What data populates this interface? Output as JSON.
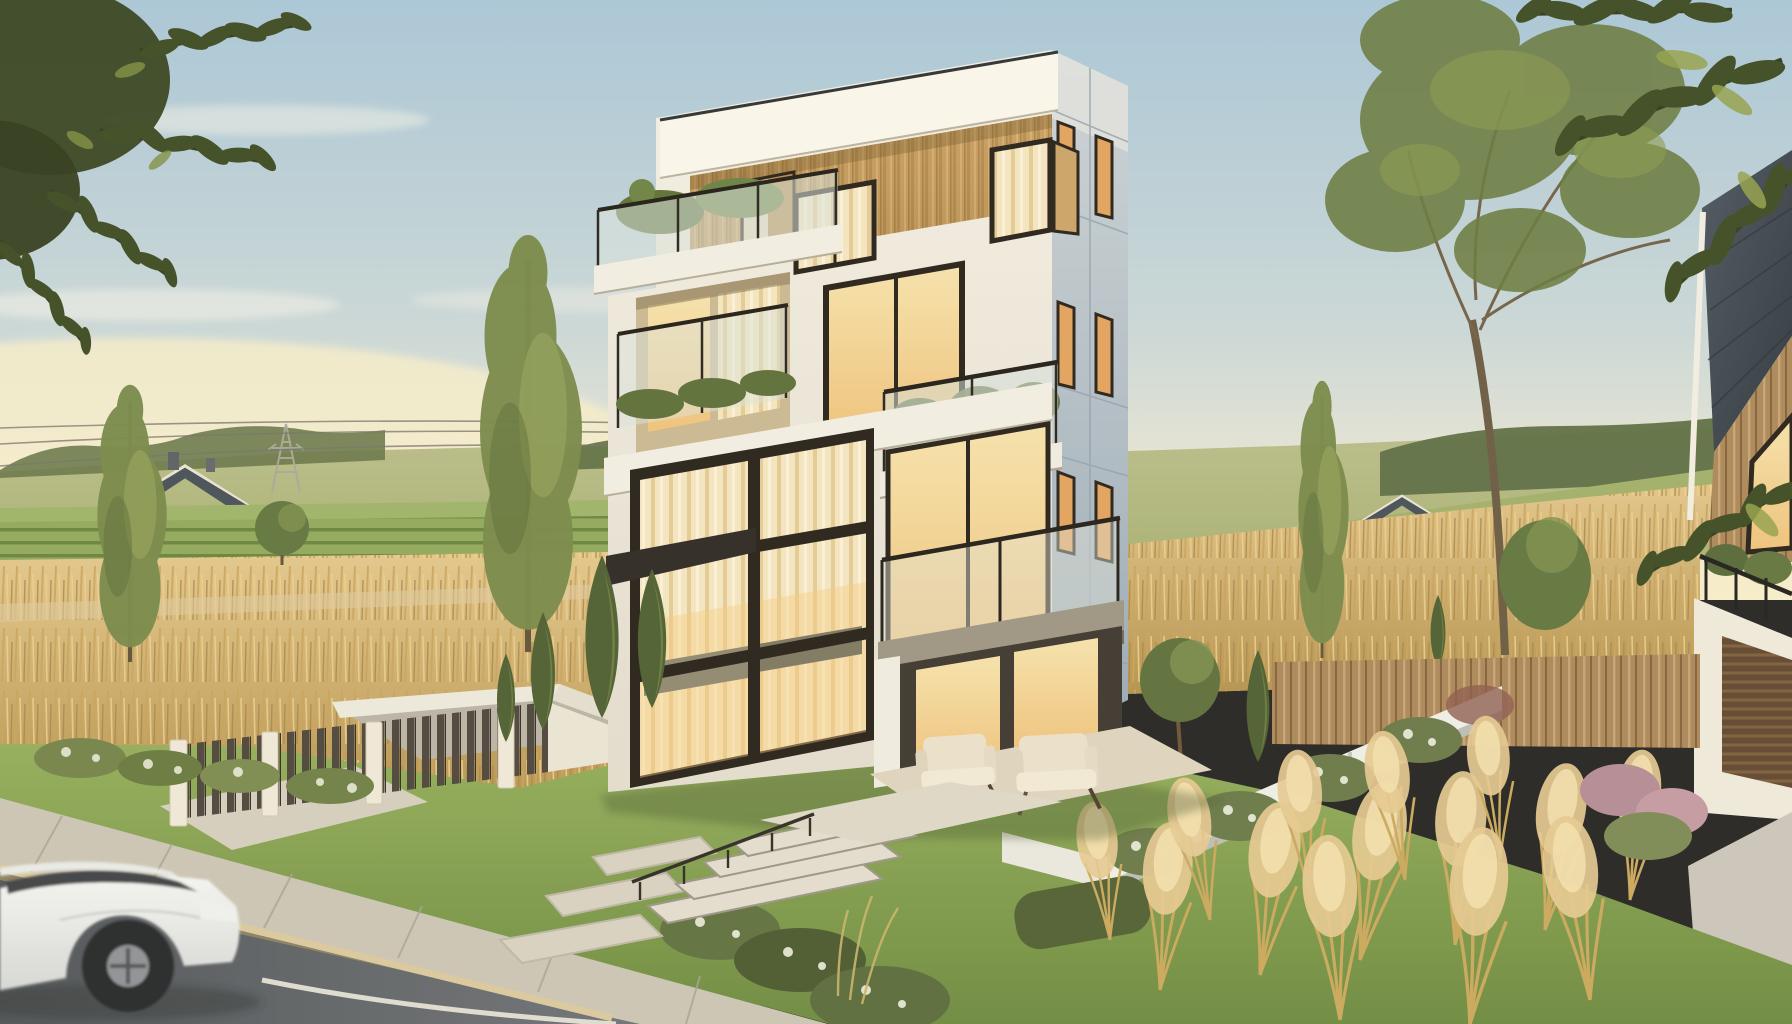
{
  "scene": {
    "title": "Modern three-storey house with timber-clad top floor in a golden-hour suburban field landscape",
    "type": "photorealistic architectural exterior render",
    "time_of_day": "late afternoon golden hour",
    "sky": "clear pale blue sky with warm haze and thin clouds near the horizon",
    "setting": "new suburban street bordered by an asphalt road, sidewalk, wheat fields and rolling hills"
  },
  "objects": [
    {
      "name": "main-house",
      "description": "cubic modern house, white panel facade, vertical timber cladding on top floor, black window frames, glass balconies, warm lit interiors"
    },
    {
      "name": "roof-terrace",
      "description": "glass-railed roof terrace with planter greenery on the third-floor roof"
    },
    {
      "name": "double-height-glazing",
      "description": "two-storey window wall with black mullion grid and cream curtains"
    },
    {
      "name": "porch",
      "description": "recessed ground-floor terrace with two cream armchairs"
    },
    {
      "name": "entrance-steps",
      "description": "light concrete steps with a thin black handrail and stepping-stone path"
    },
    {
      "name": "front-fence",
      "description": "white masonry pillars with dark vertical metal slats"
    },
    {
      "name": "driveway-ramp",
      "description": "white-walled driveway ramp beside the fence"
    },
    {
      "name": "white-suv",
      "description": "white SUV driving past on the road, slightly motion-blurred"
    },
    {
      "name": "road",
      "description": "dark asphalt road with painted white edge line and tan curb"
    },
    {
      "name": "sidewalk",
      "description": "light concrete sidewalk with diagonal joint lines"
    },
    {
      "name": "front-lawn",
      "description": "green lawn with flower beds and clipped shrubs"
    },
    {
      "name": "cypresses",
      "description": "slender dark conifers in the left garden"
    },
    {
      "name": "poplar-trees",
      "description": "three columnar poplar trees"
    },
    {
      "name": "large-tree",
      "description": "tall open-crowned deciduous tree right of the house"
    },
    {
      "name": "overhanging-leaves",
      "description": "dark leafy branches framing the upper corners"
    },
    {
      "name": "wheat-field",
      "description": "golden grain field with green crop rows behind the fence"
    },
    {
      "name": "rolling-hills",
      "description": "olive-green distant hills with a dark tree line"
    },
    {
      "name": "distant-houses-left",
      "description": "cluster of small white gabled houses with slate roofs and chimneys"
    },
    {
      "name": "distant-house-right",
      "description": "single white gabled house across the right field"
    },
    {
      "name": "power-pylon",
      "description": "lattice transmission tower with sagging power lines"
    },
    {
      "name": "retaining-wall",
      "description": "low white garden wall running diagonally up the slope"
    },
    {
      "name": "pampas-grass",
      "description": "feathery golden ornamental grasses in the right garden"
    },
    {
      "name": "boxwood-hedge",
      "description": "clipped dark green hedge"
    },
    {
      "name": "wooden-fence",
      "description": "run of vertical timber fence boards behind the garden"
    },
    {
      "name": "neighbor-house",
      "description": "adjacent house with dark shingled roof, timber gable, balcony and slatted garage door"
    }
  ],
  "palette": {
    "sky-top": "#a7c6da",
    "sky-mid": "#c9d8da",
    "sky-horizon": "#efead7",
    "horizon-glow": "#f7eecb",
    "hill": "#a8b277",
    "treeline": "#66774a",
    "wheat": "#d8b876",
    "wheat-dark": "#b3924f",
    "lawn": "#84a04f",
    "lawn-dark": "#6b8a40",
    "foliage": "#5d7038",
    "foliage-dark": "#39481f",
    "foliage-light": "#93a55c",
    "house-white": "#f3f0e8",
    "fascia": "#faf7ef",
    "side-face": "#b5c2cc",
    "wood-clad": "#c6a066",
    "window-frame": "#241f19",
    "curtain": "#f4e6c0",
    "curtain-lit": "#eec27c",
    "glass": "#d9e4e0",
    "roof-distant": "#454f5a",
    "distant-wall": "#f0ede3",
    "road": "#565c62",
    "sidewalk": "#cbc5b6",
    "curb": "#d9c9a0",
    "road-line": "#e9e7dc",
    "car-body": "#f4f6f5",
    "car-glass": "#3c4147",
    "wheel": "#23262a",
    "pampas": "#e4c992",
    "fence-slat": "#4b443c",
    "fence-pillar": "#efe9da",
    "wood-fence": "#b08c5c",
    "neighbor-roof": "#3b4650",
    "garage-door": "#5f4630",
    "bloom-pink": "#b38b96",
    "flower-white": "#eef0e2"
  }
}
